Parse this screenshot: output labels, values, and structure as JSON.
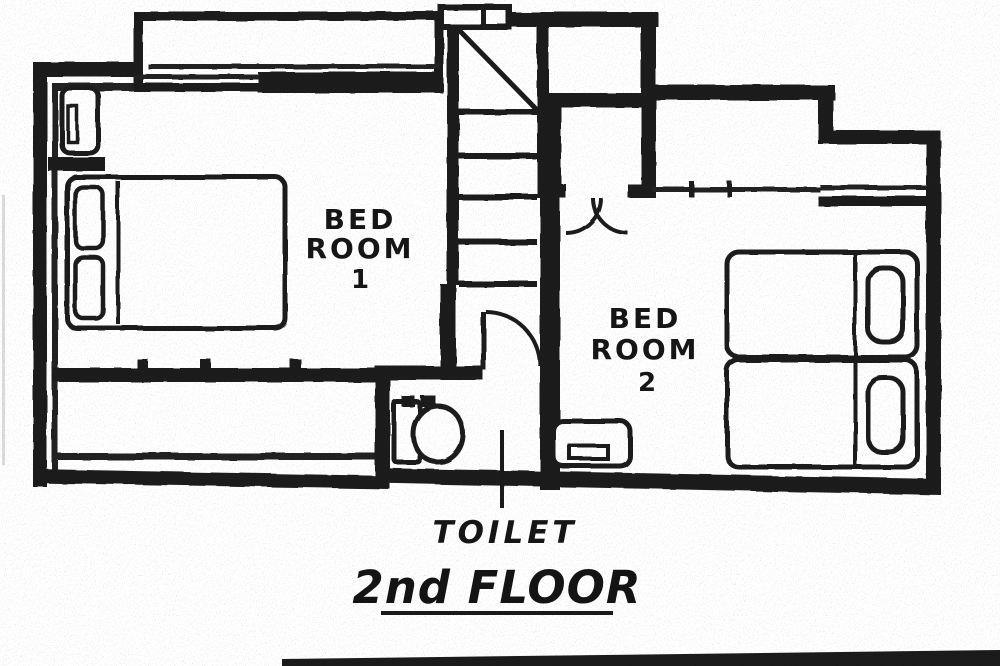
{
  "plan": {
    "type": "architectural-floor-plan",
    "floor_caption": "2nd FLOOR",
    "rooms": {
      "bedroom1": {
        "name_line1": "BED",
        "name_line2": "ROOM",
        "name_line3": "1"
      },
      "bedroom2": {
        "name_line1": "BED",
        "name_line2": "ROOM",
        "name_line3": "2"
      },
      "toilet": {
        "label": "TOILET"
      }
    },
    "fixtures": [
      "double-bed",
      "twin-beds",
      "toilet",
      "staircase",
      "double-door-closet",
      "balcony",
      "washbasin",
      "tv-stand"
    ],
    "colors": {
      "ink": "#1b1b1b",
      "paper": "#ffffff"
    }
  }
}
